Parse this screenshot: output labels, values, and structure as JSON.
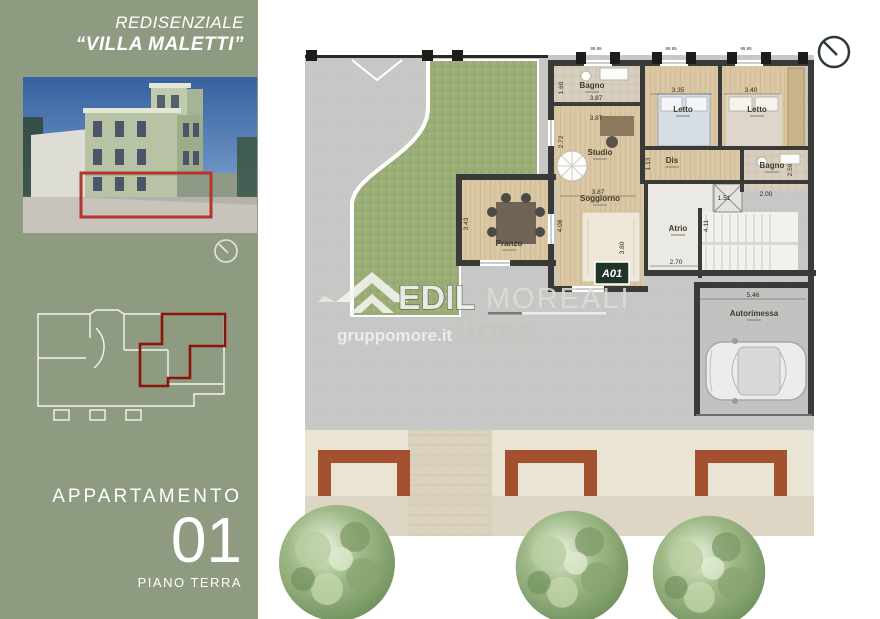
{
  "header": {
    "title_line1": "REDISENZIALE",
    "title_line2": "“VILLA MALETTI”"
  },
  "sidebar": {
    "apartment_label": "APPARTAMENTO",
    "apartment_number": "01",
    "floor_label": "PIANO TERRA"
  },
  "watermark": {
    "brand_bold": "EDIL",
    "brand_serif": "MOREALI",
    "site": "gruppomore.it",
    "brand_secondary": "MORE"
  },
  "plan": {
    "unit_badge": "A01",
    "rooms": {
      "bagno_top": "Bagno",
      "letto_a": "Letto",
      "letto_b": "Letto",
      "studio": "Studio",
      "dis": "Dis",
      "bagno_right": "Bagno",
      "soggiorno": "Soggiorno",
      "pranzo": "Pranzo",
      "atrio": "Atrio",
      "autorimessa": "Autorimessa"
    },
    "dims": {
      "bagno_w": "3.87",
      "studio_w": "3.87",
      "letto_a_w": "3.35",
      "letto_b_w": "3.40",
      "bagno_h": "1.60",
      "studio_h": "2.72",
      "dis_h": "1.13",
      "bagno2_h": "2.59",
      "soggiorno_w": "3.87",
      "soggiorno_h": "4.08",
      "soggiorno_h2": "3.80",
      "pranzo_h": "3.43",
      "atrio_h": "4.11",
      "atrio_w": "2.70",
      "elevator_w": "1.51",
      "bagno2_w": "2.00",
      "garage_w": "5.46",
      "tiny": "95 95"
    }
  },
  "colors": {
    "sidebar_green": "#8e9b81",
    "accent_red": "#8a150b",
    "planter_rust": "#a4512f",
    "wall_dark": "#3a3a38",
    "garden_green": "#9aad76",
    "badge_green": "#20342a"
  }
}
